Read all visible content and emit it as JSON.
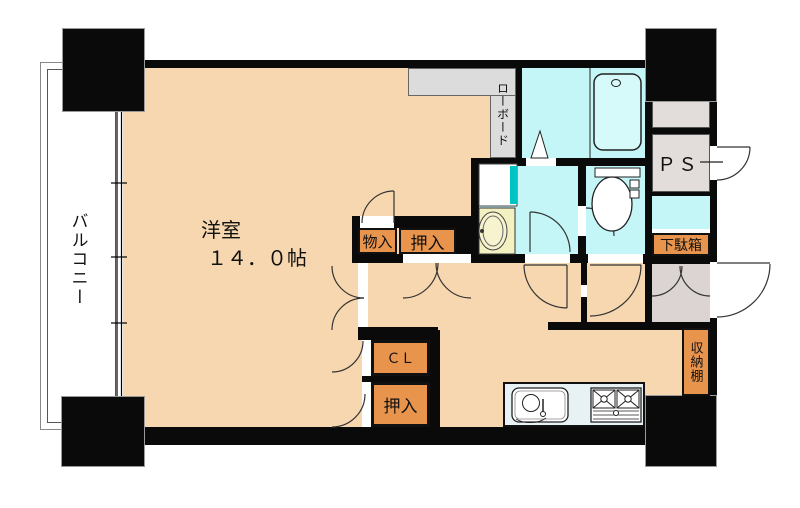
{
  "plan": {
    "title": "間取り図",
    "balcony": {
      "label": "バルコニー"
    },
    "living_room": {
      "label": "洋室",
      "size": "１４．０帖"
    },
    "lowboard": {
      "label": "ローボード"
    },
    "pipe_space": {
      "label": "ＰＳ"
    },
    "storage_small": {
      "label": "物入"
    },
    "closet_upper": {
      "label": "押入"
    },
    "closet_cl": {
      "label": "ＣＬ"
    },
    "closet_lower": {
      "label": "押入"
    },
    "shoe_cabinet": {
      "label": "下駄箱"
    },
    "storage_shelf": {
      "label": "収納棚"
    },
    "colors": {
      "floor_peach": "#F7D7AF",
      "closet_orange": "#E8944C",
      "wet_area_cyan": "#C4F6F7",
      "counter_gray": "#DCDCDC",
      "entrance_gray": "#DCD4D2",
      "vanity_yellow": "#F3F0C2",
      "kitchen_counter_blue": "#E8F2F5",
      "accent_teal": "#00C4C4",
      "wall_black": "#0A0A0A"
    }
  }
}
